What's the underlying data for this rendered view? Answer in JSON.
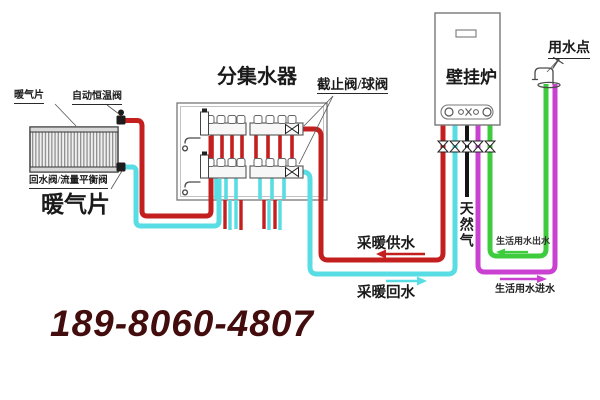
{
  "labels": {
    "radiator_tag": "暖气片",
    "thermostatic_valve": "自动恒温阀",
    "return_balance_valve": "回水阀/流量平衡阀",
    "radiator_title": "暖气片",
    "manifold_title": "分集水器",
    "stop_ball_valve": "截止阀/球阀",
    "boiler": "壁挂炉",
    "water_point": "用水点",
    "natural_gas": "天然气",
    "heating_supply": "采暖供水",
    "heating_return": "采暖回水",
    "dhw_outlet": "生活用水出水",
    "dhw_inlet": "生活用水进水"
  },
  "phone": "189-8060-4807",
  "colors": {
    "supply": "#c41f1f",
    "ret": "#57dde3",
    "gas": "#141414",
    "outlet": "#3ecb3e",
    "inlet": "#ca41d2",
    "phone": "#430d0d",
    "outline": "#767676"
  }
}
